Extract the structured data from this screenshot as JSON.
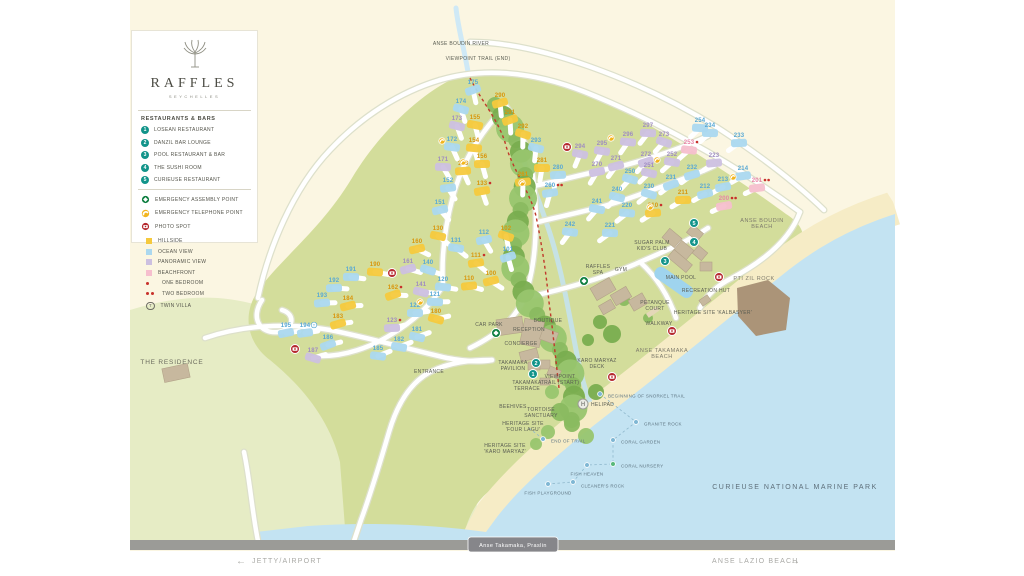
{
  "brand": {
    "name": "RAFFLES",
    "subtitle": "SEYCHELLES"
  },
  "legend": {
    "restaurants_title": "RESTAURANTS & BARS",
    "restaurants": [
      {
        "num": "1",
        "label": "LOSEAN RESTAURANT"
      },
      {
        "num": "2",
        "label": "DANZIL BAR LOUNGE"
      },
      {
        "num": "3",
        "label": "POOL RESTAURANT & BAR"
      },
      {
        "num": "4",
        "label": "THE SUSHI ROOM"
      },
      {
        "num": "5",
        "label": "CURIEUSE RESTAURANT"
      }
    ],
    "points": [
      {
        "type": "assembly",
        "label": "EMERGENCY ASSEMBLY POINT"
      },
      {
        "type": "telephone",
        "label": "EMERGENCY TELEPHONE POINT"
      },
      {
        "type": "photo",
        "label": "PHOTO SPOT"
      }
    ],
    "categories": [
      {
        "kind": "swatch",
        "color": "#f5c93d",
        "label": "HILLSIDE"
      },
      {
        "kind": "swatch",
        "color": "#abd8ef",
        "label": "OCEAN VIEW"
      },
      {
        "kind": "swatch",
        "color": "#ccc0e0",
        "label": "PANORAMIC VIEW"
      },
      {
        "kind": "swatch",
        "color": "#f6bfce",
        "label": "BEACHFRONT"
      },
      {
        "kind": "dots1",
        "label": "ONE BEDROOM"
      },
      {
        "kind": "dots2",
        "label": "TWO BEDROOM"
      },
      {
        "kind": "twin",
        "label": "TWIN VILLA"
      }
    ]
  },
  "colors": {
    "hillside": "#f5c93d",
    "ocean": "#abd8ef",
    "panoramic": "#ccc0e0",
    "beachfront": "#f6bfce",
    "hillside_txt": "#d9960b",
    "ocean_txt": "#57a8d5",
    "panoramic_txt": "#9f8cc1",
    "beachfront_txt": "#e884a6",
    "facility": "#12948a",
    "assembly": "#0b7d3e",
    "telephone": "#f2b51e",
    "photo": "#b5282e",
    "bedroom_dot": "#c8312b",
    "land": "#d3dd9b",
    "land_light": "#e6ecc5",
    "sand": "#f6ecc6",
    "water": "#c3e3f2",
    "cream": "#fbf6e2",
    "bar": "#9b9b97"
  },
  "map": {
    "villas": [
      {
        "n": "175",
        "x": 473,
        "y": 90,
        "c": "o"
      },
      {
        "n": "174",
        "x": 461,
        "y": 109,
        "c": "o"
      },
      {
        "n": "173",
        "x": 457,
        "y": 126,
        "c": "p"
      },
      {
        "n": "155",
        "x": 475,
        "y": 125,
        "c": "h"
      },
      {
        "n": "172",
        "x": 452,
        "y": 147,
        "c": "o"
      },
      {
        "n": "154",
        "x": 474,
        "y": 148,
        "c": "h"
      },
      {
        "n": "171",
        "x": 443,
        "y": 167,
        "c": "p"
      },
      {
        "n": "156",
        "x": 482,
        "y": 164,
        "c": "h"
      },
      {
        "n": "153",
        "x": 463,
        "y": 171,
        "c": "h"
      },
      {
        "n": "152",
        "x": 448,
        "y": 188,
        "c": "o"
      },
      {
        "n": "133",
        "x": 482,
        "y": 191,
        "c": "h",
        "d": 1
      },
      {
        "n": "151",
        "x": 440,
        "y": 210,
        "c": "o"
      },
      {
        "n": "290",
        "x": 500,
        "y": 103,
        "c": "h"
      },
      {
        "n": "291",
        "x": 510,
        "y": 120,
        "c": "h"
      },
      {
        "n": "292",
        "x": 523,
        "y": 134,
        "c": "h"
      },
      {
        "n": "293",
        "x": 536,
        "y": 148,
        "c": "o"
      },
      {
        "n": "294",
        "x": 580,
        "y": 154,
        "c": "p"
      },
      {
        "n": "295",
        "x": 602,
        "y": 151,
        "c": "p"
      },
      {
        "n": "296",
        "x": 628,
        "y": 142,
        "c": "p"
      },
      {
        "n": "297",
        "x": 648,
        "y": 133,
        "c": "p"
      },
      {
        "n": "281",
        "x": 542,
        "y": 168,
        "c": "h"
      },
      {
        "n": "280",
        "x": 558,
        "y": 175,
        "c": "o"
      },
      {
        "n": "261",
        "x": 523,
        "y": 182,
        "c": "h"
      },
      {
        "n": "260",
        "x": 550,
        "y": 193,
        "c": "o",
        "d": 2
      },
      {
        "n": "270",
        "x": 597,
        "y": 172,
        "c": "p"
      },
      {
        "n": "271",
        "x": 616,
        "y": 166,
        "c": "p"
      },
      {
        "n": "272",
        "x": 646,
        "y": 162,
        "c": "p"
      },
      {
        "n": "273",
        "x": 664,
        "y": 142,
        "c": "p"
      },
      {
        "n": "250",
        "x": 630,
        "y": 179,
        "c": "o"
      },
      {
        "n": "251",
        "x": 649,
        "y": 173,
        "c": "p"
      },
      {
        "n": "252",
        "x": 672,
        "y": 162,
        "c": "p"
      },
      {
        "n": "253",
        "x": 689,
        "y": 150,
        "c": "b",
        "d": 1
      },
      {
        "n": "254",
        "x": 700,
        "y": 128,
        "c": "o"
      },
      {
        "n": "234",
        "x": 710,
        "y": 133,
        "c": "o"
      },
      {
        "n": "233",
        "x": 739,
        "y": 143,
        "c": "o"
      },
      {
        "n": "223",
        "x": 714,
        "y": 163,
        "c": "p"
      },
      {
        "n": "214",
        "x": 743,
        "y": 176,
        "c": "o"
      },
      {
        "n": "213",
        "x": 723,
        "y": 187,
        "c": "o"
      },
      {
        "n": "212",
        "x": 705,
        "y": 194,
        "c": "o"
      },
      {
        "n": "232",
        "x": 692,
        "y": 175,
        "c": "o"
      },
      {
        "n": "231",
        "x": 671,
        "y": 185,
        "c": "o"
      },
      {
        "n": "230",
        "x": 649,
        "y": 194,
        "c": "o"
      },
      {
        "n": "240",
        "x": 617,
        "y": 197,
        "c": "o"
      },
      {
        "n": "241",
        "x": 597,
        "y": 209,
        "c": "o"
      },
      {
        "n": "242",
        "x": 570,
        "y": 232,
        "c": "o"
      },
      {
        "n": "220",
        "x": 627,
        "y": 213,
        "c": "o"
      },
      {
        "n": "221",
        "x": 610,
        "y": 233,
        "c": "o"
      },
      {
        "n": "211",
        "x": 683,
        "y": 200,
        "c": "h"
      },
      {
        "n": "210",
        "x": 653,
        "y": 213,
        "c": "h",
        "d": 1
      },
      {
        "n": "201",
        "x": 757,
        "y": 188,
        "c": "b",
        "d": 2
      },
      {
        "n": "200",
        "x": 724,
        "y": 206,
        "c": "b",
        "d": 2
      },
      {
        "n": "160",
        "x": 417,
        "y": 249,
        "c": "h"
      },
      {
        "n": "161",
        "x": 408,
        "y": 269,
        "c": "p"
      },
      {
        "n": "162",
        "x": 393,
        "y": 295,
        "c": "h",
        "d": 1
      },
      {
        "n": "140",
        "x": 428,
        "y": 270,
        "c": "o"
      },
      {
        "n": "141",
        "x": 421,
        "y": 292,
        "c": "p"
      },
      {
        "n": "130",
        "x": 438,
        "y": 236,
        "c": "h"
      },
      {
        "n": "131",
        "x": 456,
        "y": 248,
        "c": "o"
      },
      {
        "n": "120",
        "x": 443,
        "y": 287,
        "c": "o"
      },
      {
        "n": "121",
        "x": 435,
        "y": 302,
        "c": "o"
      },
      {
        "n": "122",
        "x": 415,
        "y": 313,
        "c": "o"
      },
      {
        "n": "123",
        "x": 392,
        "y": 328,
        "c": "p",
        "d": 1
      },
      {
        "n": "110",
        "x": 469,
        "y": 286,
        "c": "h"
      },
      {
        "n": "111",
        "x": 476,
        "y": 263,
        "c": "h",
        "d": 1
      },
      {
        "n": "112",
        "x": 484,
        "y": 240,
        "c": "o"
      },
      {
        "n": "100",
        "x": 491,
        "y": 281,
        "c": "h"
      },
      {
        "n": "101",
        "x": 508,
        "y": 257,
        "c": "o"
      },
      {
        "n": "102",
        "x": 506,
        "y": 236,
        "c": "h"
      },
      {
        "n": "180",
        "x": 436,
        "y": 319,
        "c": "h"
      },
      {
        "n": "181",
        "x": 417,
        "y": 337,
        "c": "o"
      },
      {
        "n": "182",
        "x": 399,
        "y": 347,
        "c": "o"
      },
      {
        "n": "185",
        "x": 378,
        "y": 356,
        "c": "o"
      },
      {
        "n": "190",
        "x": 375,
        "y": 272,
        "c": "h"
      },
      {
        "n": "191",
        "x": 351,
        "y": 277,
        "c": "o"
      },
      {
        "n": "192",
        "x": 334,
        "y": 288,
        "c": "o"
      },
      {
        "n": "193",
        "x": 322,
        "y": 303,
        "c": "o"
      },
      {
        "n": "194",
        "x": 305,
        "y": 333,
        "c": "o",
        "twin": true
      },
      {
        "n": "195",
        "x": 286,
        "y": 333,
        "c": "o"
      },
      {
        "n": "184",
        "x": 348,
        "y": 306,
        "c": "h"
      },
      {
        "n": "183",
        "x": 338,
        "y": 324,
        "c": "h"
      },
      {
        "n": "186",
        "x": 328,
        "y": 345,
        "c": "o"
      },
      {
        "n": "187",
        "x": 313,
        "y": 358,
        "c": "p"
      }
    ],
    "facilities": [
      {
        "num": "1",
        "x": 533,
        "y": 374
      },
      {
        "num": "2",
        "x": 536,
        "y": 363
      },
      {
        "num": "3",
        "x": 665,
        "y": 261
      },
      {
        "num": "4",
        "x": 694,
        "y": 242
      },
      {
        "num": "5",
        "x": 694,
        "y": 223
      }
    ],
    "assembly_points": [
      [
        496,
        333
      ],
      [
        584,
        281
      ]
    ],
    "photo_spots": [
      [
        567,
        147
      ],
      [
        392,
        273
      ],
      [
        295,
        349
      ],
      [
        719,
        277
      ],
      [
        672,
        331
      ],
      [
        612,
        377
      ]
    ],
    "telephone_points": [
      [
        442,
        141
      ],
      [
        463,
        162
      ],
      [
        611,
        138
      ],
      [
        657,
        160
      ],
      [
        733,
        177
      ],
      [
        650,
        207
      ],
      [
        522,
        183
      ],
      [
        420,
        302
      ]
    ],
    "helipad": {
      "x": 583,
      "y": 404,
      "label": "HELIPAD"
    },
    "labels": [
      {
        "t": "ANSE BOUDIN RIVER",
        "x": 461,
        "y": 45,
        "c": "lbl"
      },
      {
        "t": "VIEWPOINT TRAIL (END)",
        "x": 478,
        "y": 60,
        "c": "lbl"
      },
      {
        "t": "THE RESIDENCE",
        "x": 172,
        "y": 364,
        "c": "big"
      },
      {
        "t": "ENTRANCE",
        "x": 429,
        "y": 373,
        "c": "lbl"
      },
      {
        "t": "CAR PARK",
        "x": 489,
        "y": 326,
        "c": "lbl"
      },
      {
        "t": "RECEPTION",
        "x": 529,
        "y": 331,
        "c": "lbl"
      },
      {
        "t": "BOUTIQUE",
        "x": 548,
        "y": 322,
        "c": "lbl"
      },
      {
        "t": "CONCIERGE",
        "x": 521,
        "y": 345,
        "c": "lbl"
      },
      {
        "t": "TAKAMAKA\nPAVILION",
        "x": 513,
        "y": 364,
        "c": "lbl"
      },
      {
        "t": "TAKAMAKA\nTERRACE",
        "x": 527,
        "y": 384,
        "c": "lbl"
      },
      {
        "t": "RAFFLES\nSPA",
        "x": 598,
        "y": 268,
        "c": "lbl"
      },
      {
        "t": "GYM",
        "x": 621,
        "y": 271,
        "c": "lbl"
      },
      {
        "t": "SUGAR PALM\nKID'S CLUB",
        "x": 652,
        "y": 244,
        "c": "lbl"
      },
      {
        "t": "MAIN POOL",
        "x": 681,
        "y": 279,
        "c": "lbl"
      },
      {
        "t": "PETANQUE\nCOURT",
        "x": 655,
        "y": 304,
        "c": "lbl"
      },
      {
        "t": "RECREATION HUT",
        "x": 706,
        "y": 292,
        "c": "lbl"
      },
      {
        "t": "HERITAGE SITE 'KALBASYER'",
        "x": 713,
        "y": 314,
        "c": "lbl"
      },
      {
        "t": "WALKWAY",
        "x": 659,
        "y": 325,
        "c": "lbl"
      },
      {
        "t": "ANSE TAKAMAKA\nBEACH",
        "x": 662,
        "y": 352,
        "c": "beach"
      },
      {
        "t": "ANSE BOUDIN\nBEACH",
        "x": 762,
        "y": 222,
        "c": "beach"
      },
      {
        "t": "PTI ZIL ROCK",
        "x": 754,
        "y": 280,
        "c": "beach"
      },
      {
        "t": "KARO MARYAZ\nDECK",
        "x": 597,
        "y": 362,
        "c": "lbl"
      },
      {
        "t": "VIEWPOINT\nTRAIL (START)",
        "x": 560,
        "y": 378,
        "c": "lbl"
      },
      {
        "t": "BEEHIVES",
        "x": 513,
        "y": 408,
        "c": "lbl"
      },
      {
        "t": "TORTOISE\nSANCTUARY",
        "x": 541,
        "y": 411,
        "c": "lbl"
      },
      {
        "t": "HERITAGE SITE\n'FOUR LAGU'",
        "x": 523,
        "y": 425,
        "c": "lbl"
      },
      {
        "t": "HERITAGE SITE\n'KARO MARYAZ'",
        "x": 505,
        "y": 447,
        "c": "lbl"
      },
      {
        "t": "CURIEUSE NATIONAL MARINE PARK",
        "x": 795,
        "y": 489,
        "c": "park"
      }
    ],
    "snorkel": {
      "trail": "600,394 636,422 613,440 613,464 587,465 573,482 548,484",
      "trail2": "543,439 529,428",
      "points": [
        {
          "t": "BEGINNING OF SNORKEL TRAIL",
          "x": 600,
          "y": 394,
          "lx": 608,
          "ly": 396,
          "a": "start"
        },
        {
          "t": "GRANITE ROCK",
          "x": 636,
          "y": 422,
          "lx": 644,
          "ly": 424,
          "a": "start"
        },
        {
          "t": "CORAL GARDEN",
          "x": 613,
          "y": 440,
          "lx": 621,
          "ly": 442,
          "a": "start"
        },
        {
          "t": "CORAL NURSERY",
          "x": 613,
          "y": 464,
          "lx": 621,
          "ly": 466,
          "a": "start",
          "green": true
        },
        {
          "t": "FISH HEAVEN",
          "x": 587,
          "y": 465,
          "lx": 587,
          "ly": 474,
          "a": "middle"
        },
        {
          "t": "CLEANER'S ROCK",
          "x": 573,
          "y": 482,
          "lx": 581,
          "ly": 486,
          "a": "start"
        },
        {
          "t": "FISH PLAYGROUND",
          "x": 548,
          "y": 484,
          "lx": 548,
          "ly": 493,
          "a": "middle"
        },
        {
          "t": "END OF TRAIL",
          "x": 543,
          "y": 439,
          "lx": 551,
          "ly": 441,
          "a": "start"
        }
      ]
    }
  },
  "footer": {
    "badge": "Anse Takamaka, Praslin",
    "left_arrow": "←",
    "left": "JETTY/AIRPORT",
    "right": "ANSE LAZIO BEACH",
    "right_arrow": "→"
  }
}
